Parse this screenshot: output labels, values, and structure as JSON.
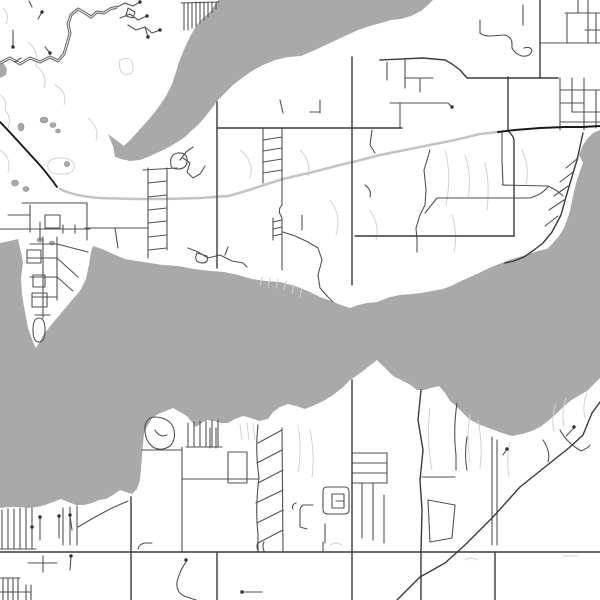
{
  "map": {
    "kind": "monochrome-street-map",
    "visible_text_labels": [],
    "colors": {
      "land": "#ffffff",
      "water": "#a9a9a9",
      "pond_outline": "#8f8f8f",
      "stream_faint": "#d2d2d2",
      "highway_gray": "#c4c4c4",
      "trunk_black": "#1a1a1a",
      "road_major": "#3a3a3a",
      "road_minor": "#515151",
      "route_casing": "#636363",
      "route_core": "#e4e4e4",
      "dot": "#2e2e2e"
    },
    "water_polygons": [
      "M218,0 L211,11 202,19 196,26 191,35 187,43 183,52 179,62 176,72 172,84 166,96 158,108 150,118 141,128 132,138 124,146 116,140 108,134 113,146 115,157 121,159 130,161 140,160 150,156 161,151 171,146 179,141 185,137 191,131 198,125 205,117 212,108 218,100 225,93 233,85 242,78 252,71 263,65 275,60 288,57 301,56 315,50 330,43 345,36 358,30 370,26 381,23 391,20 401,19 411,16 421,11 428,5 433,0 Z",
      "M0,243 L10,241 18,239 20,248 23,262 21,278 22,295 25,312 28,328 33,342 36,348 44,334 52,324 62,312 72,300 80,291 86,279 89,265 91,252 93,246 102,249 113,254 125,259 137,261 150,263 163,265 178,266 194,269 210,271 224,272 238,275 252,279 266,281 280,282 295,286 308,291 320,297 331,301 341,305 350,308 358,305 367,303 377,302 390,297 400,295 412,294 421,293 432,291 443,289 451,286 459,282 468,278 479,273 489,268 499,264 509,260 519,257 529,254 538,251 547,249 553,243 559,236 564,228 567,220 570,211 572,201 574,191 577,180 580,171 583,163 579,155 582,147 587,139 593,133 600,130 L600,378 L594,384 587,391 578,396 570,401 562,408 555,415 548,421 540,427 532,431 522,434 512,436 502,433 494,430 486,427 478,424 469,419 461,411 455,405 450,401 445,393 439,386 431,388 424,390 417,390 409,384 401,380 393,376 385,368 377,360 368,367 359,374 350,380 342,388 333,395 325,400 315,405 305,409 296,406 288,404 280,407 273,412 268,419 259,421 251,418 243,416 235,419 228,423 221,423 214,421 207,420 200,424 196,427 191,421 187,416 180,412 173,408 166,411 158,414 152,418 148,425 144,433 143,444 142,456 141,468 140,480 137,489 132,494 126,492 120,490 113,495 106,499 99,500 92,503 84,505 76,505 68,502 61,499 53,502 45,505 37,507 28,508 19,507 10,507 0,508 Z",
      "M0,61 L4,64 7,69 6,75 0,78 Z"
    ],
    "ponds": [
      {
        "cx": 21,
        "cy": 127,
        "rx": 3,
        "ry": 4
      },
      {
        "cx": 44,
        "cy": 120,
        "rx": 4,
        "ry": 3
      },
      {
        "cx": 53,
        "cy": 125,
        "rx": 3,
        "ry": 2.5
      },
      {
        "cx": 58,
        "cy": 131,
        "rx": 2.5,
        "ry": 2
      },
      {
        "cx": 67,
        "cy": 164,
        "rx": 2.7,
        "ry": 2.7
      },
      {
        "cx": 15,
        "cy": 183,
        "rx": 3.5,
        "ry": 3
      },
      {
        "cx": 26,
        "cy": 189,
        "rx": 3,
        "ry": 2.5
      },
      {
        "cx": 40,
        "cy": 240,
        "rx": 3,
        "ry": 2.2
      },
      {
        "cx": 52,
        "cy": 243,
        "rx": 2.6,
        "ry": 2
      }
    ],
    "streams_faint": [
      "M3,8 Q10,15 6,24",
      "M28,42 Q40,52 36,66 Q48,74 44,88",
      "M0,95 Q8,100 5,110 Q12,118 8,128",
      "M0,150 Q12,158 8,172",
      "M48,168 Q46,158 60,158 Q76,158 74,168 Q72,175 60,174 Q50,174 48,168 Z",
      "M120,60 Q132,55 133,66 Q134,76 124,74 Q118,72 120,60 Z",
      "M55,85 Q68,92 64,105",
      "M88,118 Q100,128 96,140",
      "M240,150 Q255,162 250,178",
      "M300,150 Q312,162 308,176",
      "M330,200 Q342,215 336,235",
      "M370,210 Q380,225 376,240",
      "M445,150 Q452,175 446,205",
      "M465,155 Q472,175 468,198",
      "M485,162 Q490,185 487,210",
      "M522,150 Q530,168 526,185",
      "M452,215 Q458,235 454,252",
      "M262,277 L260,286",
      "M270,278 L268,287",
      "M278,279 L276,288",
      "M286,281 L284,290",
      "M294,284 L292,293",
      "M302,288 L300,297",
      "M240,424 L242,440",
      "M247,423 L249,440",
      "M253,424 L255,440",
      "M298,425 Q302,448 298,472",
      "M310,430 Q315,455 312,478",
      "M430,408 Q426,440 432,470",
      "M470,414 Q466,440 470,462",
      "M478,420 Q483,445 480,468",
      "M510,443 Q506,460 509,476",
      "M556,404 Q551,418 554,432",
      "M566,398 Q561,412 564,426",
      "M587,393 Q582,405 585,418",
      "M465,560 Q472,556 478,560",
      "M563,556 L577,556",
      "M330,545 Q336,541 342,545"
    ],
    "highway_gray": [
      "M60,189 C70,194 85,197 100,198 L135,199 165,199 200,198 228,196 C245,192 260,186 283,179 L313,172 340,165 357,161 380,155 400,151 430,145 455,140 480,134 498,132"
    ],
    "trunk_black": [
      "M0,122 C10,132 25,149 38,163 C46,172 52,180 57,187",
      "M498,132 L515,130 540,128 565,127 583,127 600,126"
    ],
    "route_cased": [
      "M0,63 L10,58 20,64 30,58 40,62 50,57 58,61 64,54 67,44 70,33 68,24 71,15 78,9 85,13 91,17 97,12 104,13 110,9 117,7"
    ],
    "roads_major": [
      "M217,102 L217,268",
      "M217,128 L402,128",
      "M352,57 L352,285",
      "M355,236 L514,236",
      "M508,77 L508,131 Q514,136 514,141 L514,236",
      "M540,0 L540,78",
      "M380,60 L423,58 445,60 L452,64 460,70 467,78 L520,78 558,78",
      "M0,552 L600,552",
      "M131,497 L131,600",
      "M217,553 L217,600",
      "M352,380 L352,600",
      "M421,390 L418,420 423,450 420,480 422,510 421,552 421,600",
      "M600,402 L592,413 583,435 570,447 545,467 520,487 493,517 465,545 445,563 420,577 397,600",
      "M583,133 L581,142 577,160 571,180 566,197 561,215 552,232 543,243 534,250 524,257 514,261 505,263",
      "M495,552 L495,600"
    ],
    "roads_minor": [
      "M117,7 L125,3 133,6 140,2",
      "M120,18 L130,14 138,20 147,16",
      "M128,25 L136,30 145,27 152,33 160,30",
      "M145,27 L148,37",
      "M128,8 L135,12 133,18 126,16 Z",
      "M13,30 L13,47",
      "M42,12 L38,19",
      "M32,7 L29,1",
      "M50,53 L45,47",
      "M15,62 L21,58",
      "M181,3 L219,2",
      "M184,3 L184,30",
      "M188,3 L188,30",
      "M192,3 L192,28",
      "M196,2 L196,26",
      "M200,2 L200,23",
      "M204,2 L204,20",
      "M208,2 L208,17",
      "M212,2 L212,13",
      "M216,2 L216,9",
      "M22,203 L87,203 87,240",
      "M30,205 L30,232",
      "M8,215 L30,215",
      "M45,215 L60,215 60,228 45,228 Z",
      "M0,229 L90,229",
      "M40,222 L40,240",
      "M63,225 L63,233",
      "M75,225 L75,233",
      "M85,228 L148,228",
      "M115,228 L118,248",
      "M43,237 L43,318",
      "M57,237 L57,300",
      "M30,244 L57,244",
      "M28,258 L57,258",
      "M30,277 L57,277",
      "M32,297 L57,297",
      "M35,315 L50,315",
      "M27,250 L41,250 41,263 27,263 Z",
      "M33,275 L45,275 45,287 33,287 Z",
      "M32,293 L47,293 47,307 32,307 Z",
      "M33,330 Q33,318 39,318 Q45,318 45,330 Q45,342 39,342 Q33,342 33,330 Z",
      "M57,258 L78,277",
      "M57,277 L73,291",
      "M57,244 L88,252",
      "M148,168 L148,258",
      "M167,168 L167,250",
      "M143,170 L177,168",
      "M148,183 L167,181",
      "M148,197 L167,195",
      "M148,210 L167,208",
      "M148,223 L167,221",
      "M148,237 L167,235",
      "M148,250 L167,248",
      "M171,166 Q169,154 178,153 Q188,152 187,162 Q186,169 178,169 Q172,169 171,166 Z",
      "M180,160 L186,152 193,147",
      "M183,158 L190,163 187,172 193,178 200,174 205,166",
      "M188,248 L198,252 208,258 220,255 232,261 243,263 247,267",
      "M197,253 Q193,262 202,263 Q209,263 207,256 Z",
      "M225,255 L228,247",
      "M263,128 L263,183",
      "M282,128 L282,205 Q278,209 280,214 L282,218 282,270",
      "M263,140 L282,137",
      "M263,151 L282,148",
      "M263,162 L282,159",
      "M263,173 L282,170",
      "M273,218 L273,240",
      "M273,222 L282,220",
      "M273,229 L282,227",
      "M273,236 L282,234",
      "M283,232 L295,236 308,242 318,248 322,260 318,275 320,288 328,297 333,302",
      "M280,100 L283,113",
      "M320,100 L320,113",
      "M310,112 L320,112",
      "M372,130 L370,145 375,153",
      "M302,215 L302,230",
      "M365,185 Q372,190 370,197",
      "M400,103 L400,128",
      "M387,62 L387,80",
      "M405,60 L405,88",
      "M405,78 L433,78",
      "M420,78 L420,92",
      "M390,103 L448,103 L452,107",
      "M480,20 L480,33 Q483,36 490,36 L505,35 Q512,37 512,44 L512,48 Q515,54 522,56 Q530,57 532,51 Q531,46 524,48",
      "M523,5 L523,25",
      "M565,13 L600,13",
      "M540,43 L600,43",
      "M567,13 L567,43",
      "M578,0 L578,13",
      "M588,0 L588,43",
      "M596,13 L596,43",
      "M585,30 L600,30",
      "M560,78 L560,130",
      "M572,78 L572,112",
      "M584,78 L584,130",
      "M596,90 L596,128",
      "M560,90 L600,90",
      "M560,103 L584,103",
      "M572,112 L600,112",
      "M560,122 L600,122",
      "M578,158 L566,168",
      "M573,172 L560,182",
      "M568,186 L554,196",
      "M564,200 L549,210",
      "M558,216 L545,226",
      "M430,150 L424,170 426,190 425,205 420,215 416,228 417,240 417,252",
      "M425,213 L437,198",
      "M437,198 L530,198 Q540,195 545,190 L548,187",
      "M502,132 L502,160 503,185",
      "M502,185 L548,186 Q557,190 563,196",
      "M150,418 Q144,423 145,430 Q145,441 153,447 Q161,452 170,446 Q176,440 174,430 Q172,421 162,418 Q155,416 150,418 Z",
      "M155,430 Q159,438 167,435",
      "M142,450 L182,450",
      "M182,447 L182,552",
      "M188,423 L188,447",
      "M194,422 L194,447",
      "M200,421 L200,447",
      "M206,421 L206,447",
      "M212,420 L212,447",
      "M218,420 L218,447",
      "M186,447 L222,447",
      "M182,479 L258,479",
      "M210,428 L210,448",
      "M216,428 L216,448",
      "M228,452 L247,452 247,483 228,483 Z",
      "M2,510 L2,549",
      "M8,509 L8,549",
      "M14,509 L14,549",
      "M20,508 L20,549",
      "M26,508 L26,549",
      "M32,508 L32,549",
      "M0,549 L36,549",
      "M63,508 L63,545",
      "M70,507 L70,545",
      "M77,506 L77,545",
      "M40,518 L40,540",
      "M59,517 L59,538",
      "M70,516 L72,530",
      "M32,528 L32,540",
      "M78,527 L95,517 112,508 128,501",
      "M0,578 L20,578",
      "M3,578 L3,600",
      "M8,578 L8,600",
      "M13,578 L13,600",
      "M18,578 L18,600",
      "M26,585 L26,600",
      "M31,585 L31,600",
      "M0,592 L31,592",
      "M28,563 L57,563",
      "M43,556 L43,572",
      "M71,557 L70,570",
      "M186,562 Q180,570 177,582 Q176,592 184,596 L196,600",
      "M242,592 L262,592",
      "M138,549 Q139,544 145,543 L152,543",
      "M258,542 Q256,546 258,551",
      "M264,542 Q262,546 264,551",
      "M323,542 L323,552",
      "M258,425 Q255,450 259,478 Q255,508 258,535 L258,552",
      "M282,428 L283,552",
      "M258,443 L282,430",
      "M257,463 L282,450",
      "M258,483 L283,470",
      "M256,503 L283,490",
      "M257,523 L283,510",
      "M258,543 L283,530",
      "M352,453 L387,453",
      "M352,463 L387,463",
      "M352,473 L387,473",
      "M352,483 L387,483",
      "M387,453 L387,483",
      "M362,483 L362,538",
      "M373,483 L373,540",
      "M384,495 L384,543",
      "M327,487 L345,487 Q349,487 349,492 L349,510 Q349,514 344,514 L328,514 Q323,514 323,509 L323,491 Q323,487 327,487 Z",
      "M332,494 L344,494 344,508 332,508 Z",
      "M336,501 L344,501",
      "M313,505 L303,505 Q300,507 300,511 L300,527 L307,529",
      "M296,503 Q291,505 293,509",
      "M325,524 L325,543",
      "M492,437 L492,545",
      "M497,440 L497,545",
      "M503,455 L507,449",
      "M457,403 Q453,430 456,455 L456,470",
      "M467,437 Q464,455 467,470",
      "M422,477 L455,477",
      "M428,500 L455,505 452,538 430,542 Z",
      "M566,436 L574,428",
      "M560,430 Q566,442 581,451 Q588,448 590,445",
      "M543,440 Q551,452 548,462"
    ],
    "dots": [
      [
        13,
        47
      ],
      [
        42,
        12
      ],
      [
        50,
        53
      ],
      [
        140,
        2
      ],
      [
        147,
        16
      ],
      [
        160,
        30
      ],
      [
        148,
        37
      ],
      [
        40,
        517
      ],
      [
        59,
        516
      ],
      [
        70,
        515
      ],
      [
        32,
        527
      ],
      [
        71,
        556
      ],
      [
        186,
        560
      ],
      [
        242,
        592
      ],
      [
        507,
        449
      ],
      [
        574,
        427
      ],
      [
        452,
        107
      ]
    ]
  }
}
